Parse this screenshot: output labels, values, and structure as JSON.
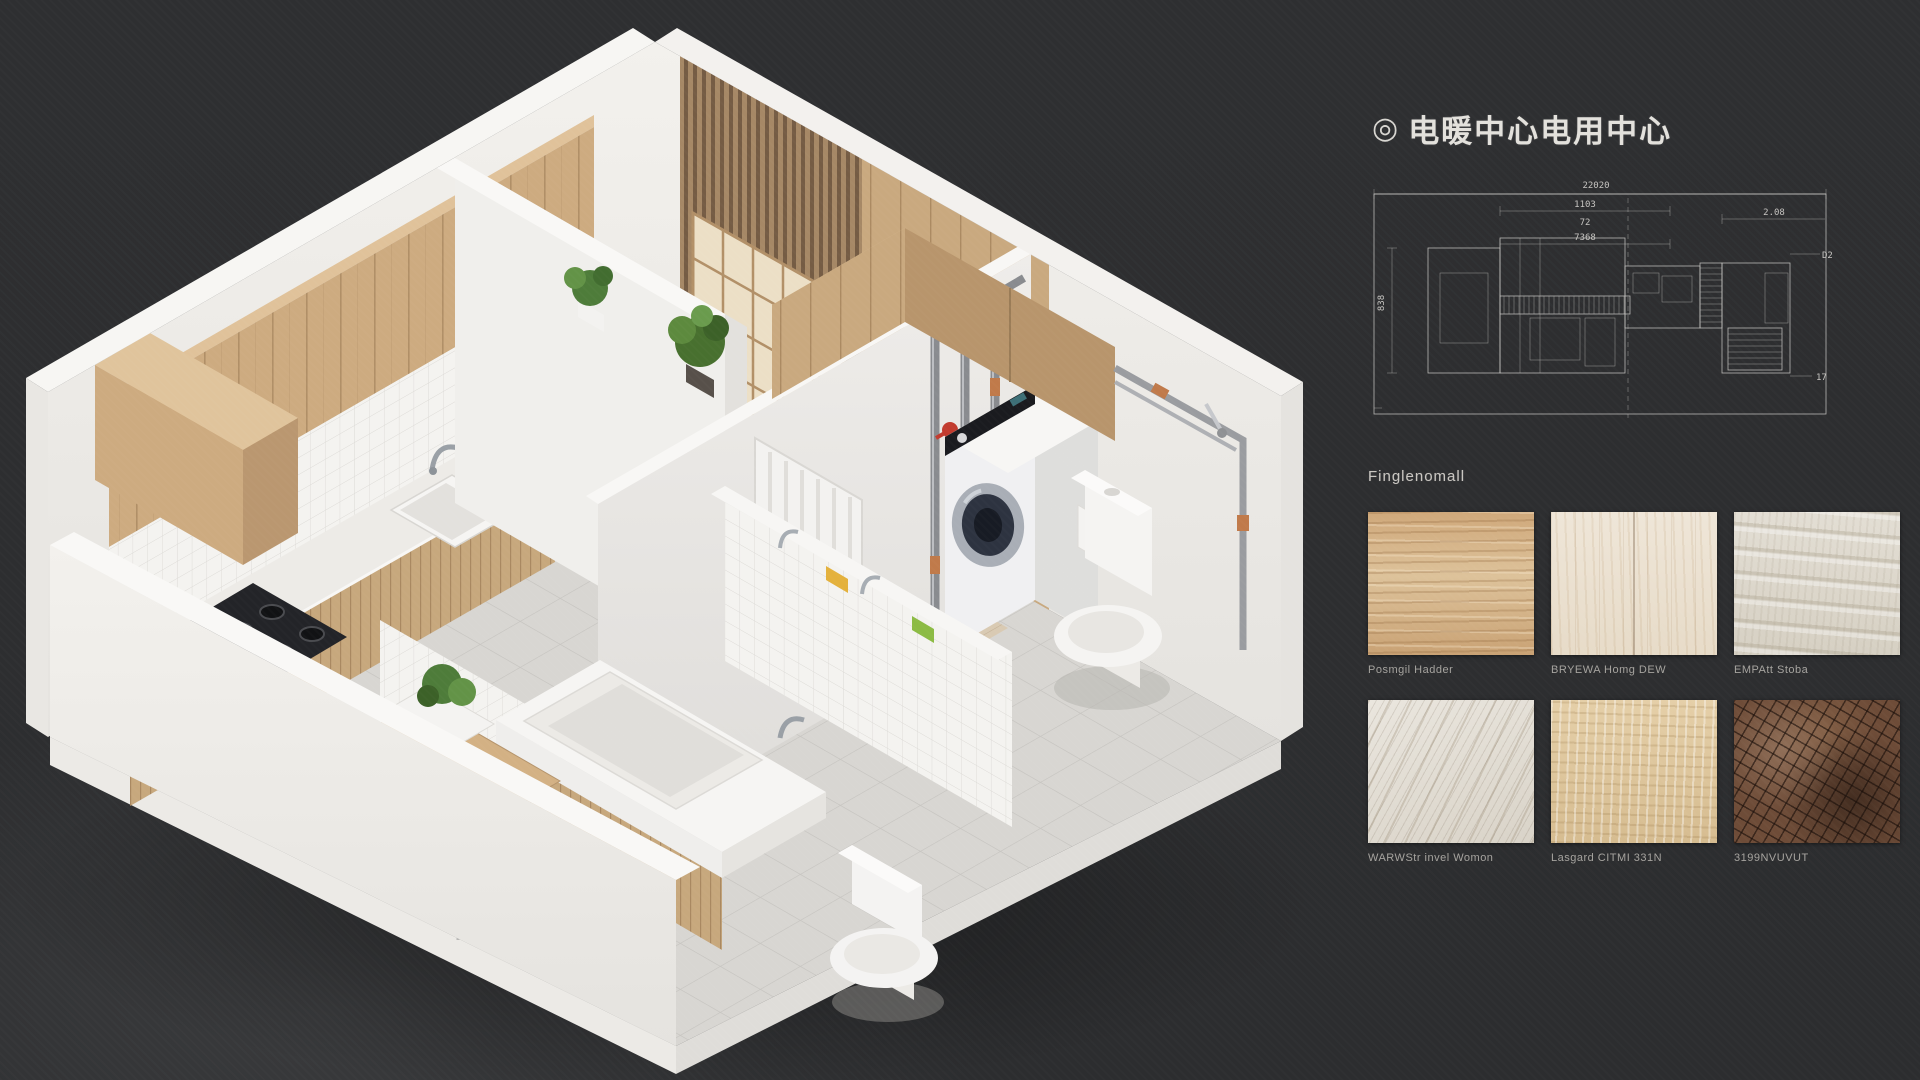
{
  "panel": {
    "title_icon": "◎",
    "title": "电暖中心电用中心",
    "materials_label": "Finglenomall",
    "blueprint": {
      "dim_top": "22020",
      "dim_a": "1103",
      "dim_b": "72",
      "dim_c": "7368",
      "dim_right": "2.08",
      "dim_tag": "D2",
      "dim_left": "838",
      "dim_small": "17"
    },
    "materials": [
      {
        "name": "Posmgil Hadder",
        "material": "oak wood"
      },
      {
        "name": "BRYEWA Homg DEW",
        "material": "whitewashed wood"
      },
      {
        "name": "EMPAtt Stoba",
        "material": "travertine"
      },
      {
        "name": "WARWStr invel Womon",
        "material": "gray marble"
      },
      {
        "name": "Lasgard CITMI 331N",
        "material": "beige stone"
      },
      {
        "name": "3199NVUVUT",
        "material": "brown mosaic"
      }
    ]
  },
  "scene": {
    "description": "Isometric cutaway render of a small apartment with kitchen, bathroom, laundry and toilet rooms",
    "colors": {
      "background": "#2d2e30",
      "wall_white": "#f0eeea",
      "wood": "#cdab80",
      "pipe_gray": "#898b8f",
      "valve_red": "#c23b2e",
      "accent_yellow": "#e4b13c",
      "accent_green": "#8cbb44"
    }
  }
}
